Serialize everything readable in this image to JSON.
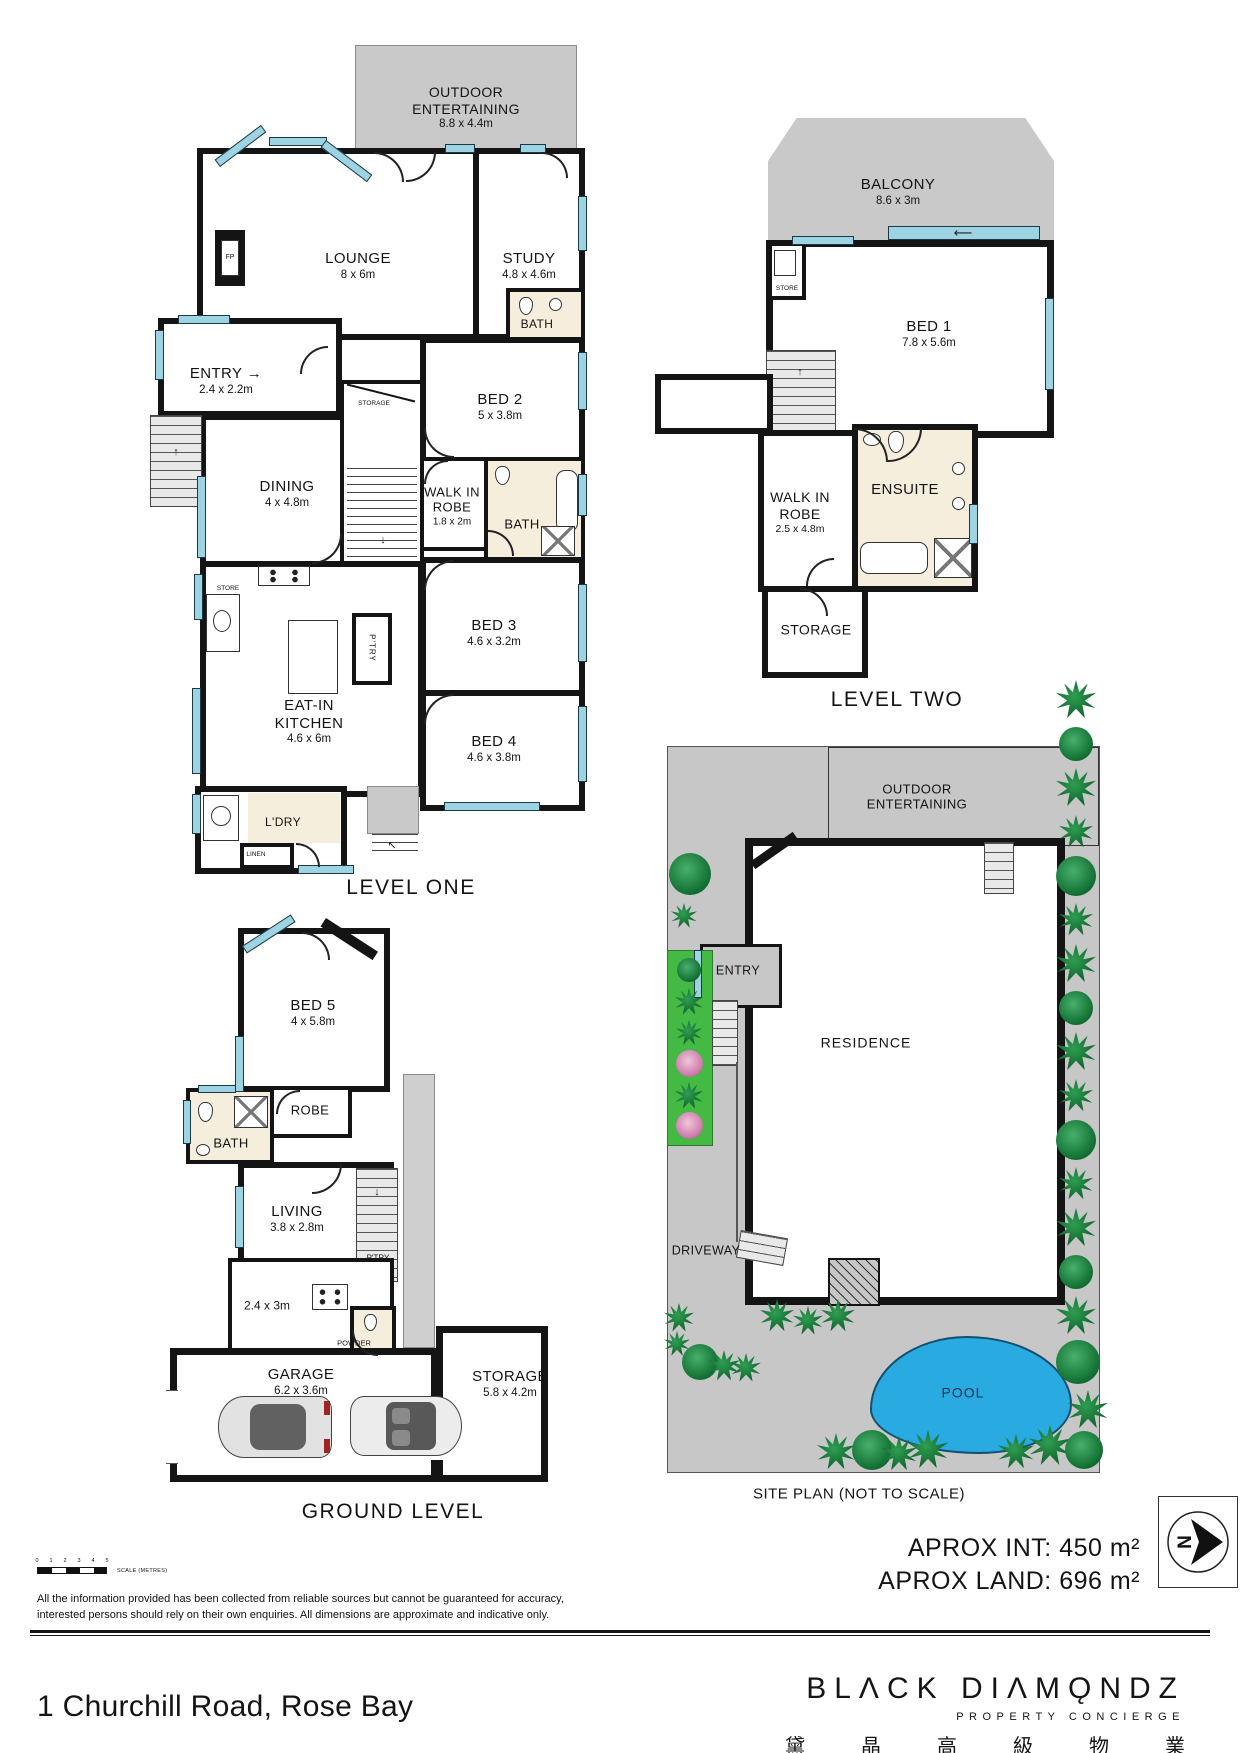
{
  "icons": {
    "up_arrow": "↑",
    "down_arrow": "↓",
    "right_arrow": "→",
    "long_left_arrow": "⟵",
    "diag_arrow": "↖"
  },
  "level_one": {
    "title": "LEVEL ONE",
    "rooms": {
      "outdoor": {
        "name": "OUTDOOR ENTERTAINING",
        "dims": "8.8 x 4.4m"
      },
      "lounge": {
        "name": "LOUNGE",
        "dims": "8 x 6m"
      },
      "study": {
        "name": "STUDY",
        "dims": "4.8 x 4.6m"
      },
      "bath_upper": {
        "name": "BATH"
      },
      "entry": {
        "name": "ENTRY",
        "dims": "2.4 x 2.2m"
      },
      "bed2": {
        "name": "BED 2",
        "dims": "5 x 3.8m"
      },
      "dining": {
        "name": "DINING",
        "dims": "4 x 4.8m"
      },
      "walk_in_robe": {
        "name": "WALK IN ROBE",
        "dims": "1.8 x 2m"
      },
      "bath": {
        "name": "BATH"
      },
      "storage": {
        "name": "STORAGE"
      },
      "store": {
        "name": "STORE"
      },
      "bed3": {
        "name": "BED 3",
        "dims": "4.6 x 3.2m"
      },
      "kitchen": {
        "name": "EAT-IN KITCHEN",
        "dims": "4.6 x 6m"
      },
      "pantry": {
        "name": "P'TRY"
      },
      "bed4": {
        "name": "BED 4",
        "dims": "4.6 x 3.8m"
      },
      "laundry": {
        "name": "L'DRY"
      },
      "linen": {
        "name": "LINEN"
      },
      "fireplace": {
        "name": "FP"
      }
    }
  },
  "level_two": {
    "title": "LEVEL TWO",
    "rooms": {
      "balcony": {
        "name": "BALCONY",
        "dims": "8.6 x 3m"
      },
      "bed1": {
        "name": "BED 1",
        "dims": "7.8 x 5.6m"
      },
      "store": {
        "name": "STORE"
      },
      "walk_in_robe": {
        "name": "WALK IN ROBE",
        "dims": "2.5 x 4.8m"
      },
      "ensuite": {
        "name": "ENSUITE"
      },
      "storage": {
        "name": "STORAGE"
      }
    }
  },
  "ground_level": {
    "title": "GROUND LEVEL",
    "rooms": {
      "bed5": {
        "name": "BED 5",
        "dims": "4 x 5.8m"
      },
      "robe": {
        "name": "ROBE"
      },
      "bath": {
        "name": "BATH"
      },
      "living": {
        "name": "LIVING",
        "dims": "3.8 x 2.8m"
      },
      "utility": {
        "dims": "2.4 x 3m"
      },
      "powder": {
        "name": "POWDER"
      },
      "pantry": {
        "name": "P'TRY"
      },
      "garage": {
        "name": "GARAGE",
        "dims": "6.2 x 3.6m"
      },
      "storage": {
        "name": "STORAGE",
        "dims": "5.8 x 4.2m"
      }
    }
  },
  "site_plan": {
    "title": "SITE PLAN (NOT TO SCALE)",
    "labels": {
      "outdoor": {
        "name": "OUTDOOR ENTERTAINING"
      },
      "entry": {
        "name": "ENTRY"
      },
      "residence": {
        "name": "RESIDENCE"
      },
      "driveway": {
        "name": "DRIVEWAY"
      },
      "pool": {
        "name": "POOL"
      }
    }
  },
  "areas": {
    "internal": "APROX INT: 450 m²",
    "land": "APROX LAND: 696 m²"
  },
  "scale_bar": {
    "numbers": [
      "0",
      "1",
      "2",
      "3",
      "4",
      "5"
    ],
    "label": "SCALE (METRES)"
  },
  "north": {
    "letter": "N"
  },
  "disclaimer": {
    "line1": "All the information provided has been collected from reliable sources but cannot be guaranteed for accuracy,",
    "line2": "interested persons should rely on their own enquiries. All dimensions are approximate and indicative only."
  },
  "footer": {
    "address": "1 Churchill Road, Rose Bay",
    "brand_name": "BLΛCK DIΛMǪNDZ",
    "brand_tagline": "PROPERTY CONCIERGE",
    "brand_chinese": "黛晶高級物業"
  },
  "colors": {
    "wall": "#141414",
    "window": "#9ed3e3",
    "outdoor_gray": "#c9c9c9",
    "bath_floor": "#f6eedc",
    "site_gray": "#c7c7c7",
    "garden_green": "#44b944",
    "tree_green": "#0f6c30",
    "pool_blue": "#29abe2"
  }
}
